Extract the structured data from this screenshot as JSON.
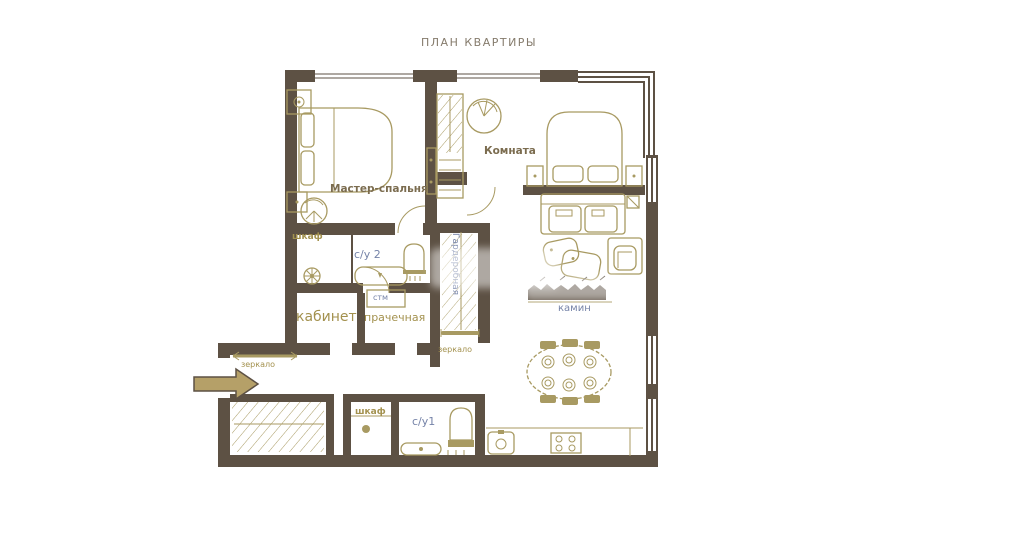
{
  "title": "ПЛАН КВАРТИРЫ",
  "rooms": {
    "master_bedroom": "Мастер-спальня",
    "room": "Комната",
    "study": "кабинет",
    "laundry": "прачечная",
    "washing_machine": "стм",
    "wardrobe": "Гардеробная",
    "bathroom2": "с/у 2",
    "bathroom1": "с/у1",
    "closet_upper": "шкаф",
    "closet_lower": "шкаф",
    "fireplace": "камин",
    "mirror_wardrobe": "зеркало",
    "mirror_entry": "зеркало"
  },
  "colors": {
    "wall": "#5d5144",
    "furniture": "#a89a62",
    "label_gold": "#a3914e",
    "label_brown": "#7b6c4f",
    "label_blue": "#7583a8",
    "title": "#857b6c",
    "arrow": "#b5a068"
  }
}
